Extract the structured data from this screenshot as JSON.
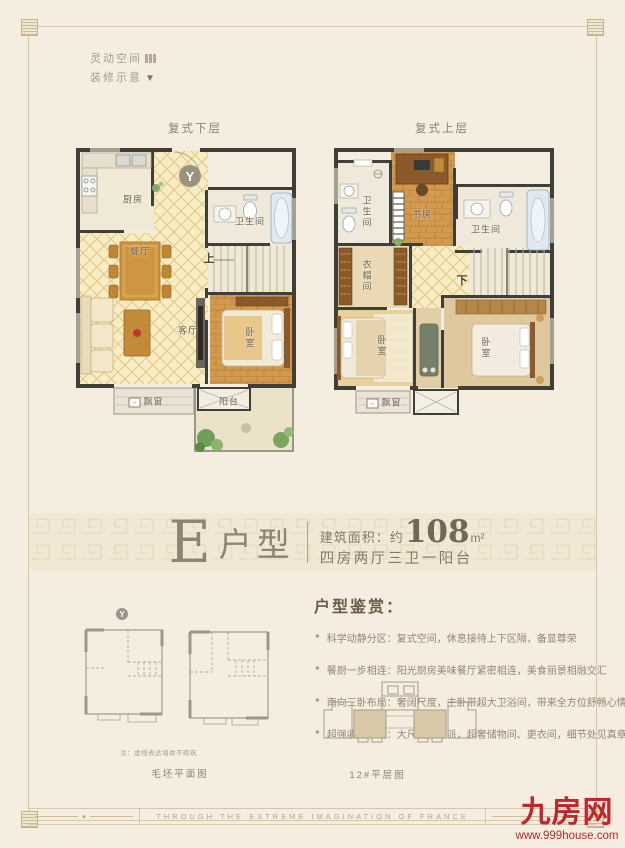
{
  "decor_note": {
    "line1": "灵动空间",
    "line2": "装修示意"
  },
  "icons": {
    "compass": "Y",
    "bay_arrow": "→",
    "dropdown": "▼",
    "bullet": "✦",
    "diamond": "◆"
  },
  "plans": {
    "lower": {
      "title": "复式下层",
      "labels": {
        "kitchen": "厨房",
        "bath": "卫生间",
        "dining": "餐厅",
        "stairs_up": "上",
        "living": "客厅",
        "bedroom": "卧室",
        "bay": "飘窗",
        "balcony": "阳台"
      }
    },
    "upper": {
      "title": "复式上层",
      "labels": {
        "bath1": "卫生间",
        "study": "书房",
        "bath2": "卫生间",
        "closet": "衣帽间",
        "stairs_down": "下",
        "bed1": "卧室",
        "bed2": "卧室",
        "bay": "飘窗"
      }
    }
  },
  "title_band": {
    "letter": "E",
    "type_label": "户型",
    "area_prefix": "建筑面积：约",
    "area_value": "108",
    "area_unit": "m²",
    "layout_desc": "四房两厅三卫一阳台"
  },
  "appreciation": {
    "heading": "户型鉴赏：",
    "bullets": [
      "科学动静分区：复式空间，休息接待上下区隔，备显尊荣",
      "餐厨一步相连：阳光厨房美味餐厅紧密相连，美食丽景相融交汇",
      "南向三卧布局：奢阔尺度，主卧带超大卫浴间，带来全方位舒畅心情",
      "超强收纳空间：大尺度大气派，超奢储物间、更衣间，细节处见真章"
    ]
  },
  "bottom_plans": {
    "note": "注：虚线表达墙体不砌筑",
    "caption_left": "毛坯平面图",
    "caption_right": "12#平层图"
  },
  "footer": {
    "band_text": "THROUGH THE EXTREME IMAGINATION OF FRANCE",
    "logo_text": "九房网",
    "logo_url": "www.999house.com",
    "logo_color": "#c0272d"
  }
}
